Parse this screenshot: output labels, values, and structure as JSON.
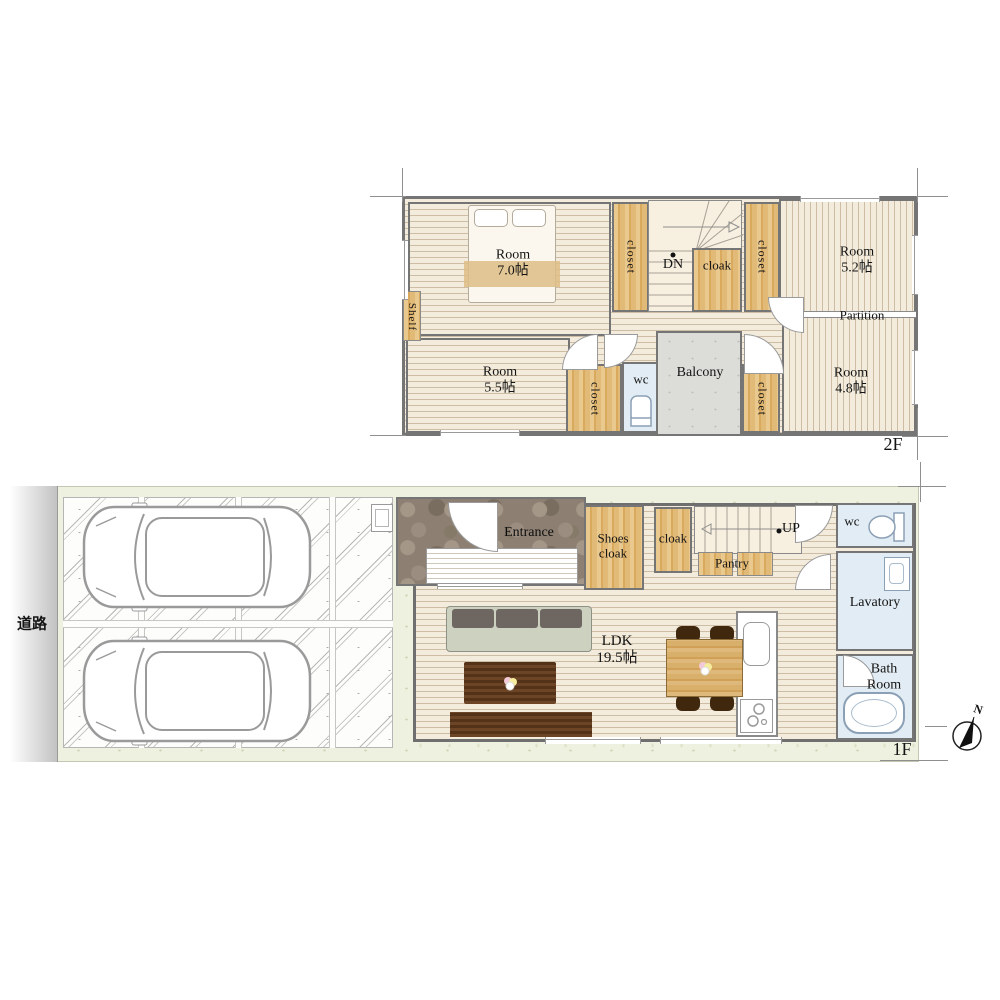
{
  "road": {
    "label": "道路"
  },
  "compass": {
    "north": "N"
  },
  "floor2": {
    "floor_label": "2F",
    "room70": {
      "name": "Room",
      "size": "7.0帖"
    },
    "room55": {
      "name": "Room",
      "size": "5.5帖"
    },
    "room52": {
      "name": "Room",
      "size": "5.2帖"
    },
    "room48": {
      "name": "Room",
      "size": "4.8帖"
    },
    "shelf": "Shelf",
    "closet": "closet",
    "dn": "DN",
    "cloak": "cloak",
    "partition": "Partition",
    "wc": "wc",
    "balcony": "Balcony"
  },
  "floor1": {
    "floor_label": "1F",
    "entrance": "Entrance",
    "shoes_cloak": {
      "line1": "Shoes",
      "line2": "cloak"
    },
    "cloak": "cloak",
    "pantry": "Pantry",
    "up": "UP",
    "wc": "wc",
    "lavatory": "Lavatory",
    "bath_room": {
      "line1": "Bath",
      "line2": "Room"
    },
    "ldk": {
      "name": "LDK",
      "size": "19.5帖"
    }
  },
  "colors": {
    "floor_cream": "#f3ecdc",
    "floor_line": "#cdbda4",
    "closet_wood": "#dfb36e",
    "water_room_blue": "#e2ecf4",
    "balcony_gray": "#dcdcd8",
    "entrance_stone": "#8d8073",
    "site_green": "#eef1e0",
    "wall_gray": "#757575"
  }
}
